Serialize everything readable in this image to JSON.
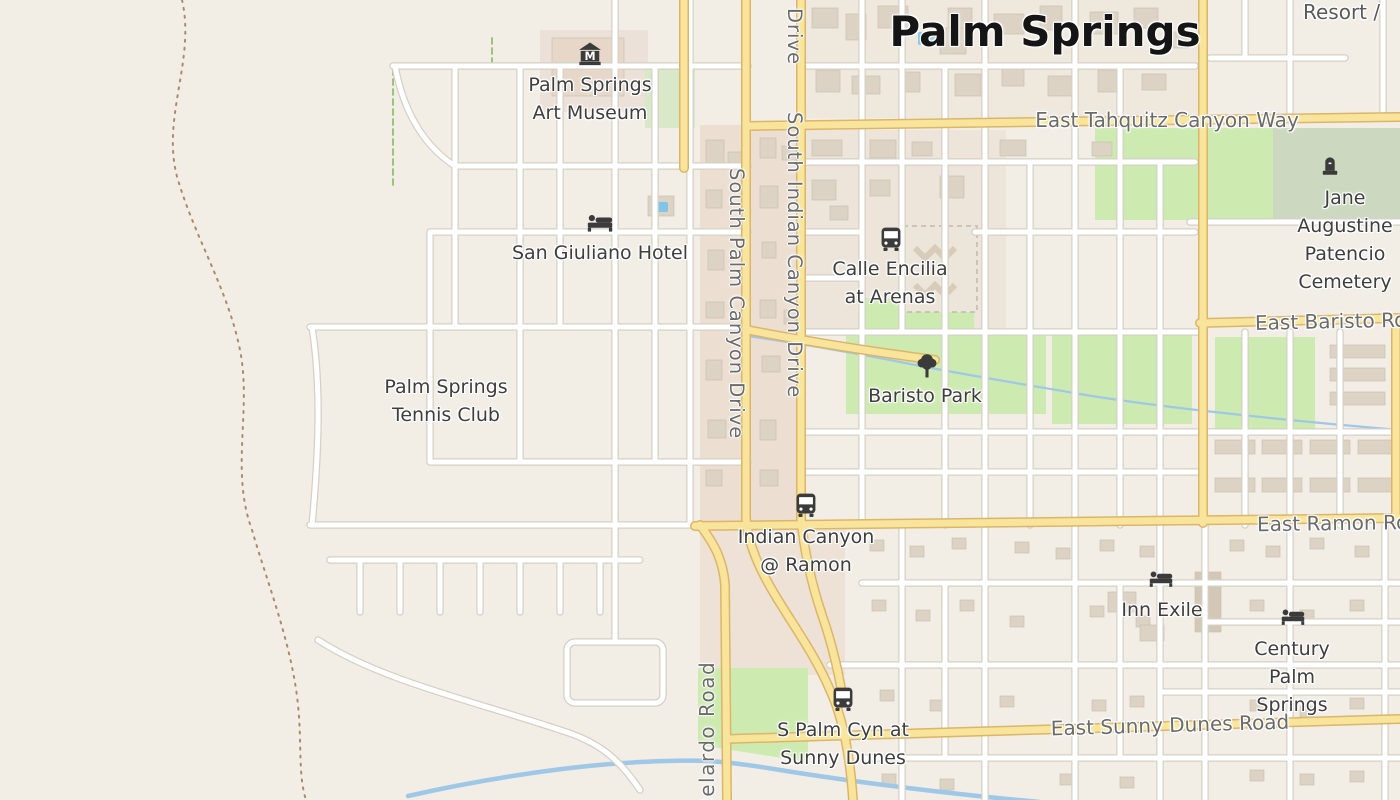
{
  "city_label": "Palm Springs",
  "corner_labels": {
    "resort": "Resort /"
  },
  "pois": {
    "art_museum": "Palm Springs\nArt Museum",
    "san_giuliano_hotel": "San Giuliano Hotel",
    "tennis_club": "Palm Springs\nTennis Club",
    "baristo_park": "Baristo Park",
    "cemetery": "Jane Augustine\nPatencio Cemetery",
    "inn_exile": "Inn Exile",
    "century_palm_springs": "Century Palm\nSprings"
  },
  "transit_stops": {
    "calle_encilia_at_arenas": "Calle Encilia\nat Arenas",
    "indian_canyon_at_ramon": "Indian Canyon\n@ Ramon",
    "s_palm_cyn_at_sunny_dunes": "S Palm Cyn at\nSunny Dunes"
  },
  "road_labels": {
    "east_tahquitz_canyon_way": "East Tahquitz Canyon Way",
    "east_baristo_road": "East Baristo Road",
    "east_ramon_road": "East Ramon Road",
    "east_sunny_dunes_road": "East Sunny Dunes Road",
    "south_palm_canyon_drive": "South Palm Canyon Drive",
    "south_indian_canyon_drive": "South Indian Canyon Drive",
    "drive_partial": "Drive",
    "belardo_road": "Belardo Road"
  },
  "icons": {
    "art_museum": "museum-icon",
    "hotels": "bed-icon",
    "bus_stops": "bus-icon",
    "park": "tree-icon",
    "cemetery": "grave-icon"
  },
  "colors": {
    "land": "#f2eee6",
    "urban_block": "#ecdfd2",
    "park_green": "#cdebb0",
    "cemetery_green": "#ccd8bf",
    "road_yellow_fill": "#f8e59b",
    "road_yellow_casing": "#dcb569",
    "street_fill": "#ffffff",
    "street_casing": "#d5d0c6",
    "water": "#9fc7e7",
    "building": "#dcd3c5",
    "poi_label": "#3e3e3e",
    "road_label": "#6b6b6b",
    "city_label": "#151515"
  }
}
